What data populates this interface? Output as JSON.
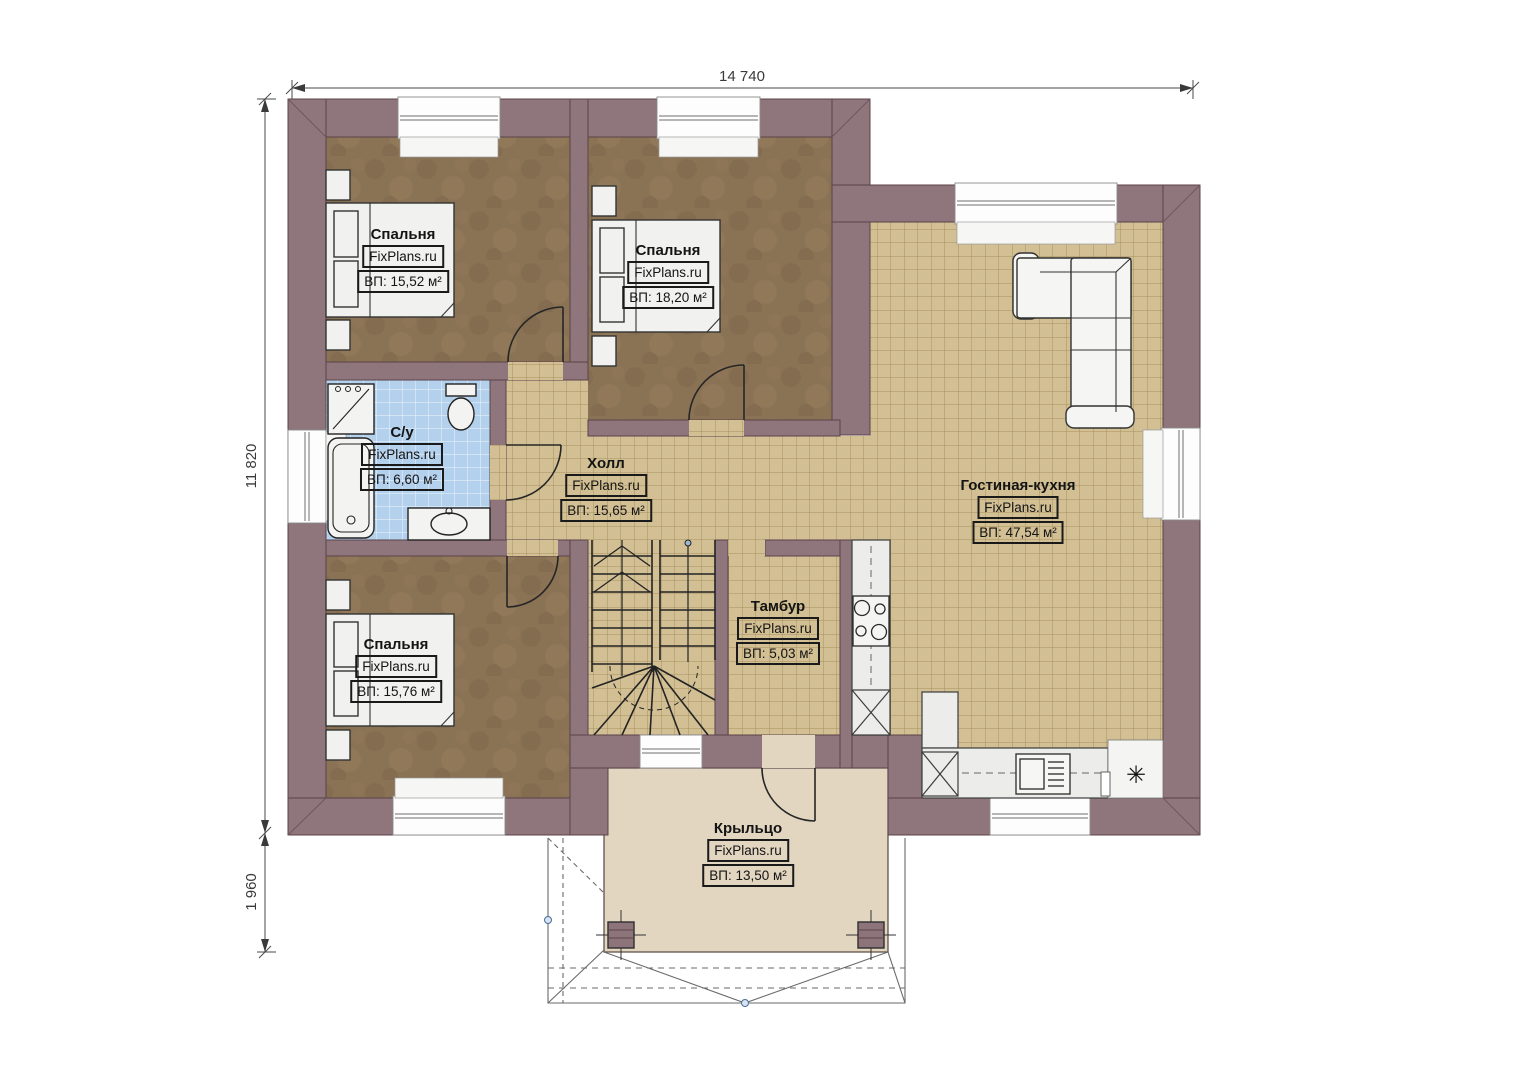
{
  "plan": {
    "dimensions": {
      "width_top": "14 740",
      "height_left": "11 820",
      "porch_depth_left": "1 960"
    },
    "rooms": {
      "bedroom1": {
        "name": "Спальня",
        "site": "FixPlans.ru",
        "area": "ВП: 15,52 м²"
      },
      "bedroom2": {
        "name": "Спальня",
        "site": "FixPlans.ru",
        "area": "ВП: 18,20 м²"
      },
      "bathroom": {
        "name": "С/у",
        "site": "FixPlans.ru",
        "area": "ВП: 6,60 м²"
      },
      "hall": {
        "name": "Холл",
        "site": "FixPlans.ru",
        "area": "ВП: 15,65 м²"
      },
      "living_kitchen": {
        "name": "Гостиная-кухня",
        "site": "FixPlans.ru",
        "area": "ВП: 47,54 м²"
      },
      "tambour": {
        "name": "Тамбур",
        "site": "FixPlans.ru",
        "area": "ВП: 5,03 м²"
      },
      "bedroom3": {
        "name": "Спальня",
        "site": "FixPlans.ru",
        "area": "ВП: 15,76 м²"
      },
      "porch": {
        "name": "Крыльцо",
        "site": "FixPlans.ru",
        "area": "ВП: 13,50 м²"
      }
    },
    "symbols": {
      "boiler": "✳"
    },
    "colors": {
      "wall": "#8f767d",
      "wall_edge": "#5b4349",
      "tile": "#d2bf94",
      "tile_grid": "#a8915f",
      "bath_tile": "#b3d0ed",
      "carpet": "#8a7254",
      "porch_floor": "#e3d6c1"
    }
  }
}
